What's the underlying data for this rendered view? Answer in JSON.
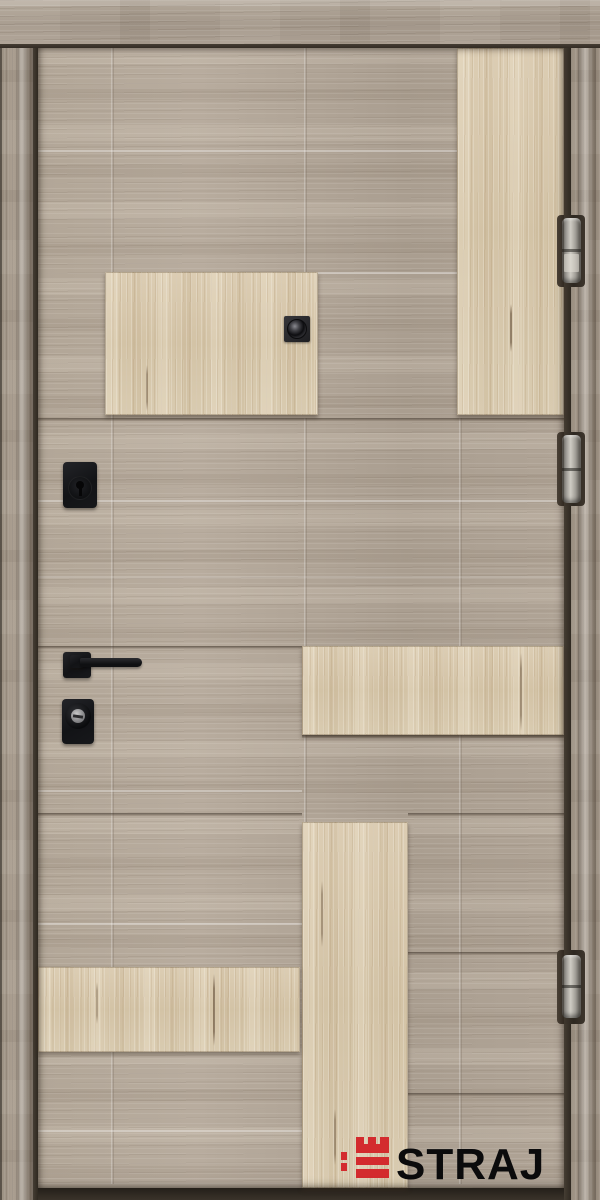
{
  "photo": {
    "subject": "entrance-door-product-photo"
  },
  "brand": {
    "logo_text": "STRAJ",
    "logo_text_color": "#0b0b0c",
    "emblem_icon": "castle-tower-icon",
    "emblem_color": "#d32b2e"
  },
  "palette": {
    "door_face_gray_oak": "#b1a597",
    "accent_panel_cream_oak": "#d8c9ae",
    "frame_wood": "#a3988a",
    "hardware_black": "#17181a",
    "hinge_metal": "#b0ada5",
    "gap_shadow": "#3a332b"
  },
  "hardware": {
    "peephole": "peephole-lens",
    "upper_lock": "deadbolt-escutcheon",
    "handle": "lever-handle",
    "lower_lock": "cylinder-escutcheon",
    "hinges_count": 3
  }
}
